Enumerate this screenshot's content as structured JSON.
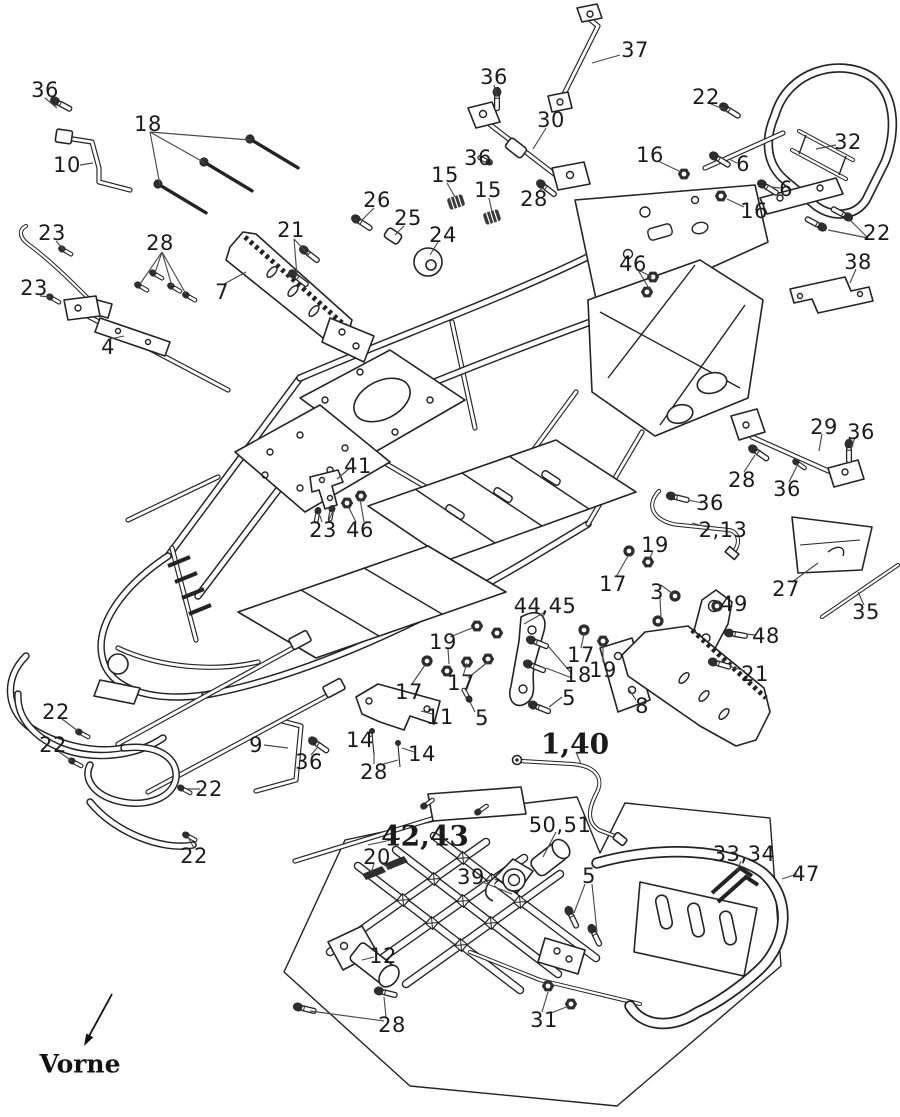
{
  "document": {
    "type": "exploded-parts-diagram",
    "subject": "Quad / ATV frame assembly exploded view",
    "orientation_label": "Vorne",
    "ink_color": "#232323",
    "background_color": "#ffffff"
  },
  "diagram": {
    "labels": [
      {
        "t": "36",
        "x": 45,
        "y": 90
      },
      {
        "t": "18",
        "x": 148,
        "y": 124
      },
      {
        "t": "10",
        "x": 67,
        "y": 165
      },
      {
        "t": "23",
        "x": 52,
        "y": 233
      },
      {
        "t": "28",
        "x": 160,
        "y": 243
      },
      {
        "t": "23",
        "x": 34,
        "y": 288
      },
      {
        "t": "7",
        "x": 222,
        "y": 292
      },
      {
        "t": "21",
        "x": 291,
        "y": 230
      },
      {
        "t": "26",
        "x": 377,
        "y": 200
      },
      {
        "t": "25",
        "x": 408,
        "y": 218
      },
      {
        "t": "24",
        "x": 443,
        "y": 235
      },
      {
        "t": "15",
        "x": 445,
        "y": 175
      },
      {
        "t": "15",
        "x": 488,
        "y": 190
      },
      {
        "t": "4",
        "x": 108,
        "y": 347
      },
      {
        "t": "36",
        "x": 494,
        "y": 77
      },
      {
        "t": "30",
        "x": 551,
        "y": 120
      },
      {
        "t": "36",
        "x": 478,
        "y": 158
      },
      {
        "t": "28",
        "x": 534,
        "y": 199
      },
      {
        "t": "37",
        "x": 635,
        "y": 50
      },
      {
        "t": "22",
        "x": 706,
        "y": 97
      },
      {
        "t": "16",
        "x": 650,
        "y": 155
      },
      {
        "t": "32",
        "x": 848,
        "y": 142
      },
      {
        "t": "6",
        "x": 743,
        "y": 164
      },
      {
        "t": "6",
        "x": 786,
        "y": 189
      },
      {
        "t": "16",
        "x": 754,
        "y": 211
      },
      {
        "t": "22",
        "x": 877,
        "y": 233
      },
      {
        "t": "38",
        "x": 858,
        "y": 262
      },
      {
        "t": "46",
        "x": 633,
        "y": 264
      },
      {
        "t": "41",
        "x": 358,
        "y": 466
      },
      {
        "t": "23",
        "x": 323,
        "y": 530
      },
      {
        "t": "46",
        "x": 360,
        "y": 530
      },
      {
        "t": "29",
        "x": 824,
        "y": 427
      },
      {
        "t": "36",
        "x": 861,
        "y": 432
      },
      {
        "t": "28",
        "x": 742,
        "y": 480
      },
      {
        "t": "36",
        "x": 787,
        "y": 489
      },
      {
        "t": "36",
        "x": 710,
        "y": 503
      },
      {
        "t": "2,13",
        "x": 723,
        "y": 530
      },
      {
        "t": "19",
        "x": 655,
        "y": 545
      },
      {
        "t": "17",
        "x": 613,
        "y": 584
      },
      {
        "t": "3",
        "x": 657,
        "y": 592
      },
      {
        "t": "27",
        "x": 786,
        "y": 589
      },
      {
        "t": "35",
        "x": 866,
        "y": 612
      },
      {
        "t": "44,45",
        "x": 545,
        "y": 606
      },
      {
        "t": "49",
        "x": 734,
        "y": 604
      },
      {
        "t": "48",
        "x": 766,
        "y": 636
      },
      {
        "t": "21",
        "x": 755,
        "y": 674
      },
      {
        "t": "17",
        "x": 581,
        "y": 655
      },
      {
        "t": "18",
        "x": 578,
        "y": 675
      },
      {
        "t": "19",
        "x": 603,
        "y": 670
      },
      {
        "t": "19",
        "x": 443,
        "y": 642
      },
      {
        "t": "17",
        "x": 409,
        "y": 692
      },
      {
        "t": "17",
        "x": 461,
        "y": 683
      },
      {
        "t": "5",
        "x": 482,
        "y": 718
      },
      {
        "t": "5",
        "x": 569,
        "y": 698
      },
      {
        "t": "8",
        "x": 642,
        "y": 706
      },
      {
        "t": "11",
        "x": 440,
        "y": 717
      },
      {
        "t": "14",
        "x": 360,
        "y": 740
      },
      {
        "t": "14",
        "x": 422,
        "y": 754
      },
      {
        "t": "28",
        "x": 374,
        "y": 772
      },
      {
        "t": "9",
        "x": 256,
        "y": 745
      },
      {
        "t": "36",
        "x": 309,
        "y": 762
      },
      {
        "t": "22",
        "x": 56,
        "y": 712
      },
      {
        "t": "22",
        "x": 53,
        "y": 745
      },
      {
        "t": "22",
        "x": 209,
        "y": 789
      },
      {
        "t": "22",
        "x": 194,
        "y": 856
      },
      {
        "t": "1,40",
        "x": 575,
        "y": 744,
        "s": "lg"
      },
      {
        "t": "42,43",
        "x": 425,
        "y": 836,
        "s": "lg"
      },
      {
        "t": "50,51",
        "x": 560,
        "y": 825
      },
      {
        "t": "20",
        "x": 377,
        "y": 857
      },
      {
        "t": "39",
        "x": 471,
        "y": 877
      },
      {
        "t": "5",
        "x": 589,
        "y": 876
      },
      {
        "t": "33,34",
        "x": 744,
        "y": 854
      },
      {
        "t": "47",
        "x": 806,
        "y": 874
      },
      {
        "t": "12",
        "x": 383,
        "y": 956
      },
      {
        "t": "31",
        "x": 544,
        "y": 1020
      },
      {
        "t": "28",
        "x": 392,
        "y": 1025
      }
    ]
  }
}
